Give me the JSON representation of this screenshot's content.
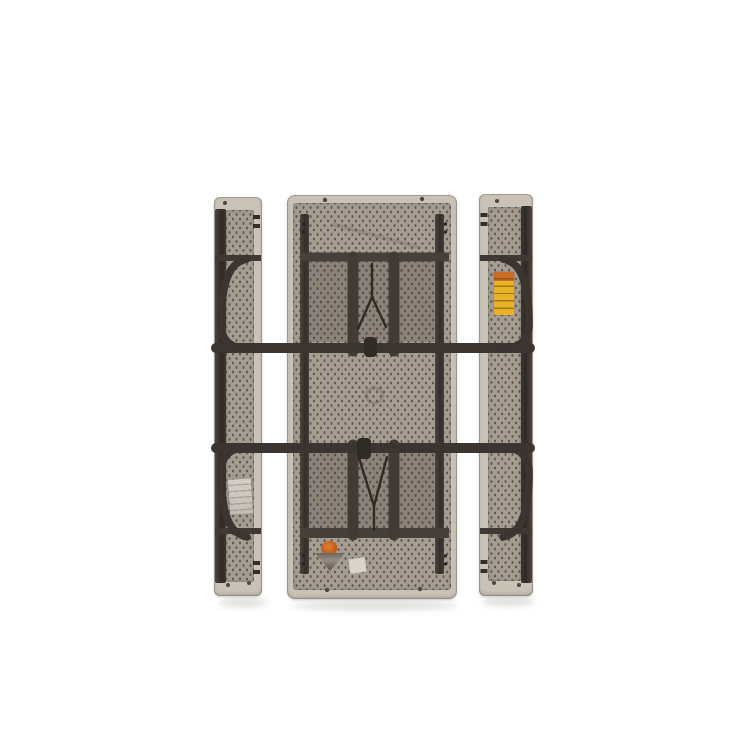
{
  "scene": {
    "type": "product-photo",
    "subject": "Folding picnic table with two attached bench seats, folded flat and photographed from the underside on a plain white background",
    "background_color": "#ffffff"
  },
  "colors": {
    "bg": "#ffffff",
    "plastic_rim": "#c9c2b7",
    "plastic_rim_edge": "#a79f94",
    "texture_base": "#a59c92",
    "texture_dot": "#5f574f",
    "metal": "#3a3531",
    "metal_light": "#4c463f",
    "bench_channel": "#332e2a",
    "leg_recess_shadow": "#3a322b",
    "label_yellow": "#e7b225",
    "label_orange": "#cc6b24",
    "label_white": "#d9d5cd",
    "label_gray_white": "#ccc8c0",
    "sticker_gray": "#8d857b",
    "ground_shadow": "#d6d4d1"
  },
  "parts": {
    "table_top": "table underside panel",
    "bench_left": "left folded bench seat",
    "bench_right": "right folded bench seat",
    "leg_frame_upper": "upper folded leg frame with cross bar and curved ends",
    "leg_frame_lower": "lower folded leg frame with cross bar and curved ends",
    "yellow_warning_label": "yellow warning sticker on right bench",
    "white_label_bench": "white product label on left bench",
    "orange_warning_sticker": "orange warning sticker on table underside",
    "white_label_table": "small white label on table underside"
  }
}
